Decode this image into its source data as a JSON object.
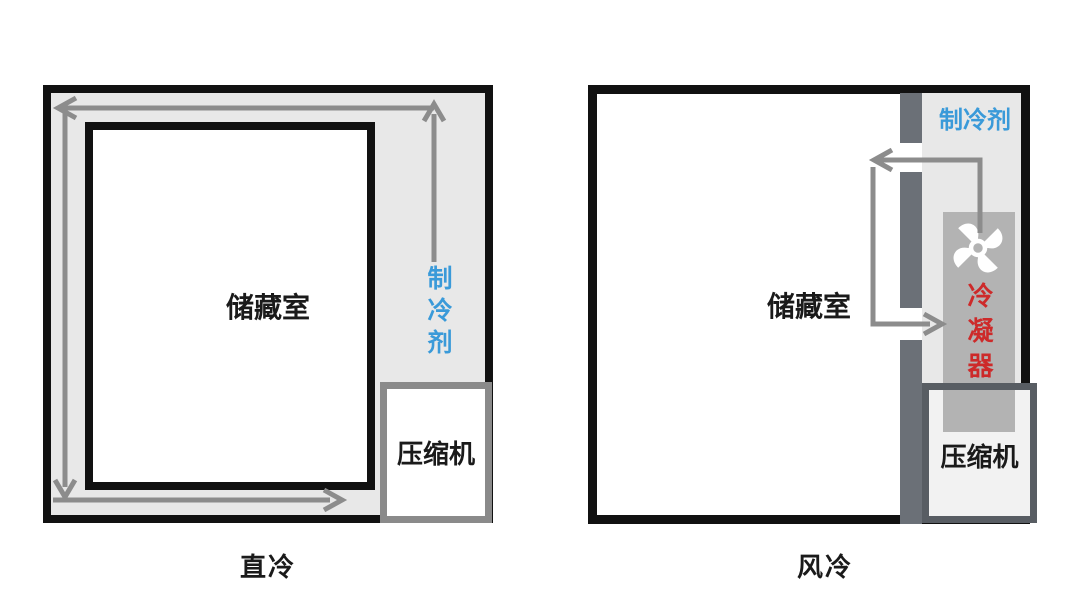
{
  "diagram_title": "refrigerator cooling comparison",
  "left_panel": {
    "caption": "直冷",
    "storage_label": "储藏室",
    "refrigerant_label": "制冷剂",
    "compressor_label": "压缩机"
  },
  "right_panel": {
    "caption": "风冷",
    "storage_label": "储藏室",
    "refrigerant_label": "制冷剂",
    "condenser_label": "冷凝器",
    "compressor_label": "压缩机",
    "fan_icon": "pinwheel-fan"
  },
  "colors": {
    "outline_black": "#111111",
    "cavity_gray": "#e8e8e8",
    "arrow_gray": "#8c8c8c",
    "duct_wall_slate": "#6b7077",
    "condenser_gray": "#b3b3b3",
    "compressor_border_left": "#8a8a8a",
    "compressor_border_right": "#585d63",
    "refrigerant_blue": "#3a9ad9",
    "condenser_red": "#cd2a2a"
  }
}
